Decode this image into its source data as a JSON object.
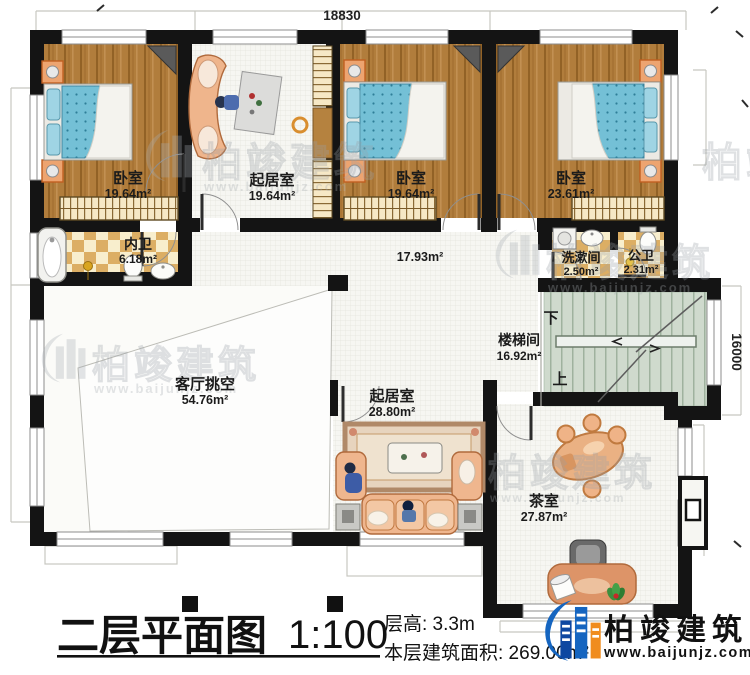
{
  "plan": {
    "drawing_type": "floor-plan",
    "rooms": [
      {
        "id": "bedroom-1",
        "name": "卧室",
        "area": "19.64m²"
      },
      {
        "id": "living-room-upper",
        "name": "起居室",
        "area": "19.64m²"
      },
      {
        "id": "bedroom-2",
        "name": "卧室",
        "area": "19.64m²"
      },
      {
        "id": "bedroom-3",
        "name": "卧室",
        "area": "23.61m²"
      },
      {
        "id": "inner-bathroom",
        "name": "内卫",
        "area": "6.18m²"
      },
      {
        "id": "hallway",
        "name": "",
        "area": "17.93m²"
      },
      {
        "id": "washroom",
        "name": "洗漱间",
        "area": "2.50m²"
      },
      {
        "id": "public-bathroom",
        "name": "公卫",
        "area": "2.31m²"
      },
      {
        "id": "stairwell",
        "name": "楼梯间",
        "area": "16.92m²"
      },
      {
        "id": "living-void",
        "name": "客厅挑空",
        "area": "54.76m²"
      },
      {
        "id": "living-room-lower",
        "name": "起居室",
        "area": "28.80m²"
      },
      {
        "id": "tea-room",
        "name": "茶室",
        "area": "27.87m²"
      }
    ],
    "stairs": {
      "down_label": "下",
      "up_label": "上"
    },
    "dimensions": {
      "top": "18830",
      "right": "16000"
    }
  },
  "title_block": {
    "title": "二层平面图",
    "scale": "1:100",
    "floor_height": "层高: 3.3m",
    "floor_area": "本层建筑面积: 269.00m²"
  },
  "brand": {
    "name": "柏竣建筑",
    "website": "www.baijunjz.com"
  },
  "watermark": {
    "name": "柏竣建筑",
    "website": "www.baijunjz.com"
  },
  "colors": {
    "wall": "#141414",
    "wood_floor": "#b17d3c",
    "bed_blue": "#74c0d6",
    "bath_tile": "#ddb066",
    "stair_green": "#cfdacd",
    "logo_blue": "#1565c0",
    "logo_orange": "#f08c1e"
  }
}
